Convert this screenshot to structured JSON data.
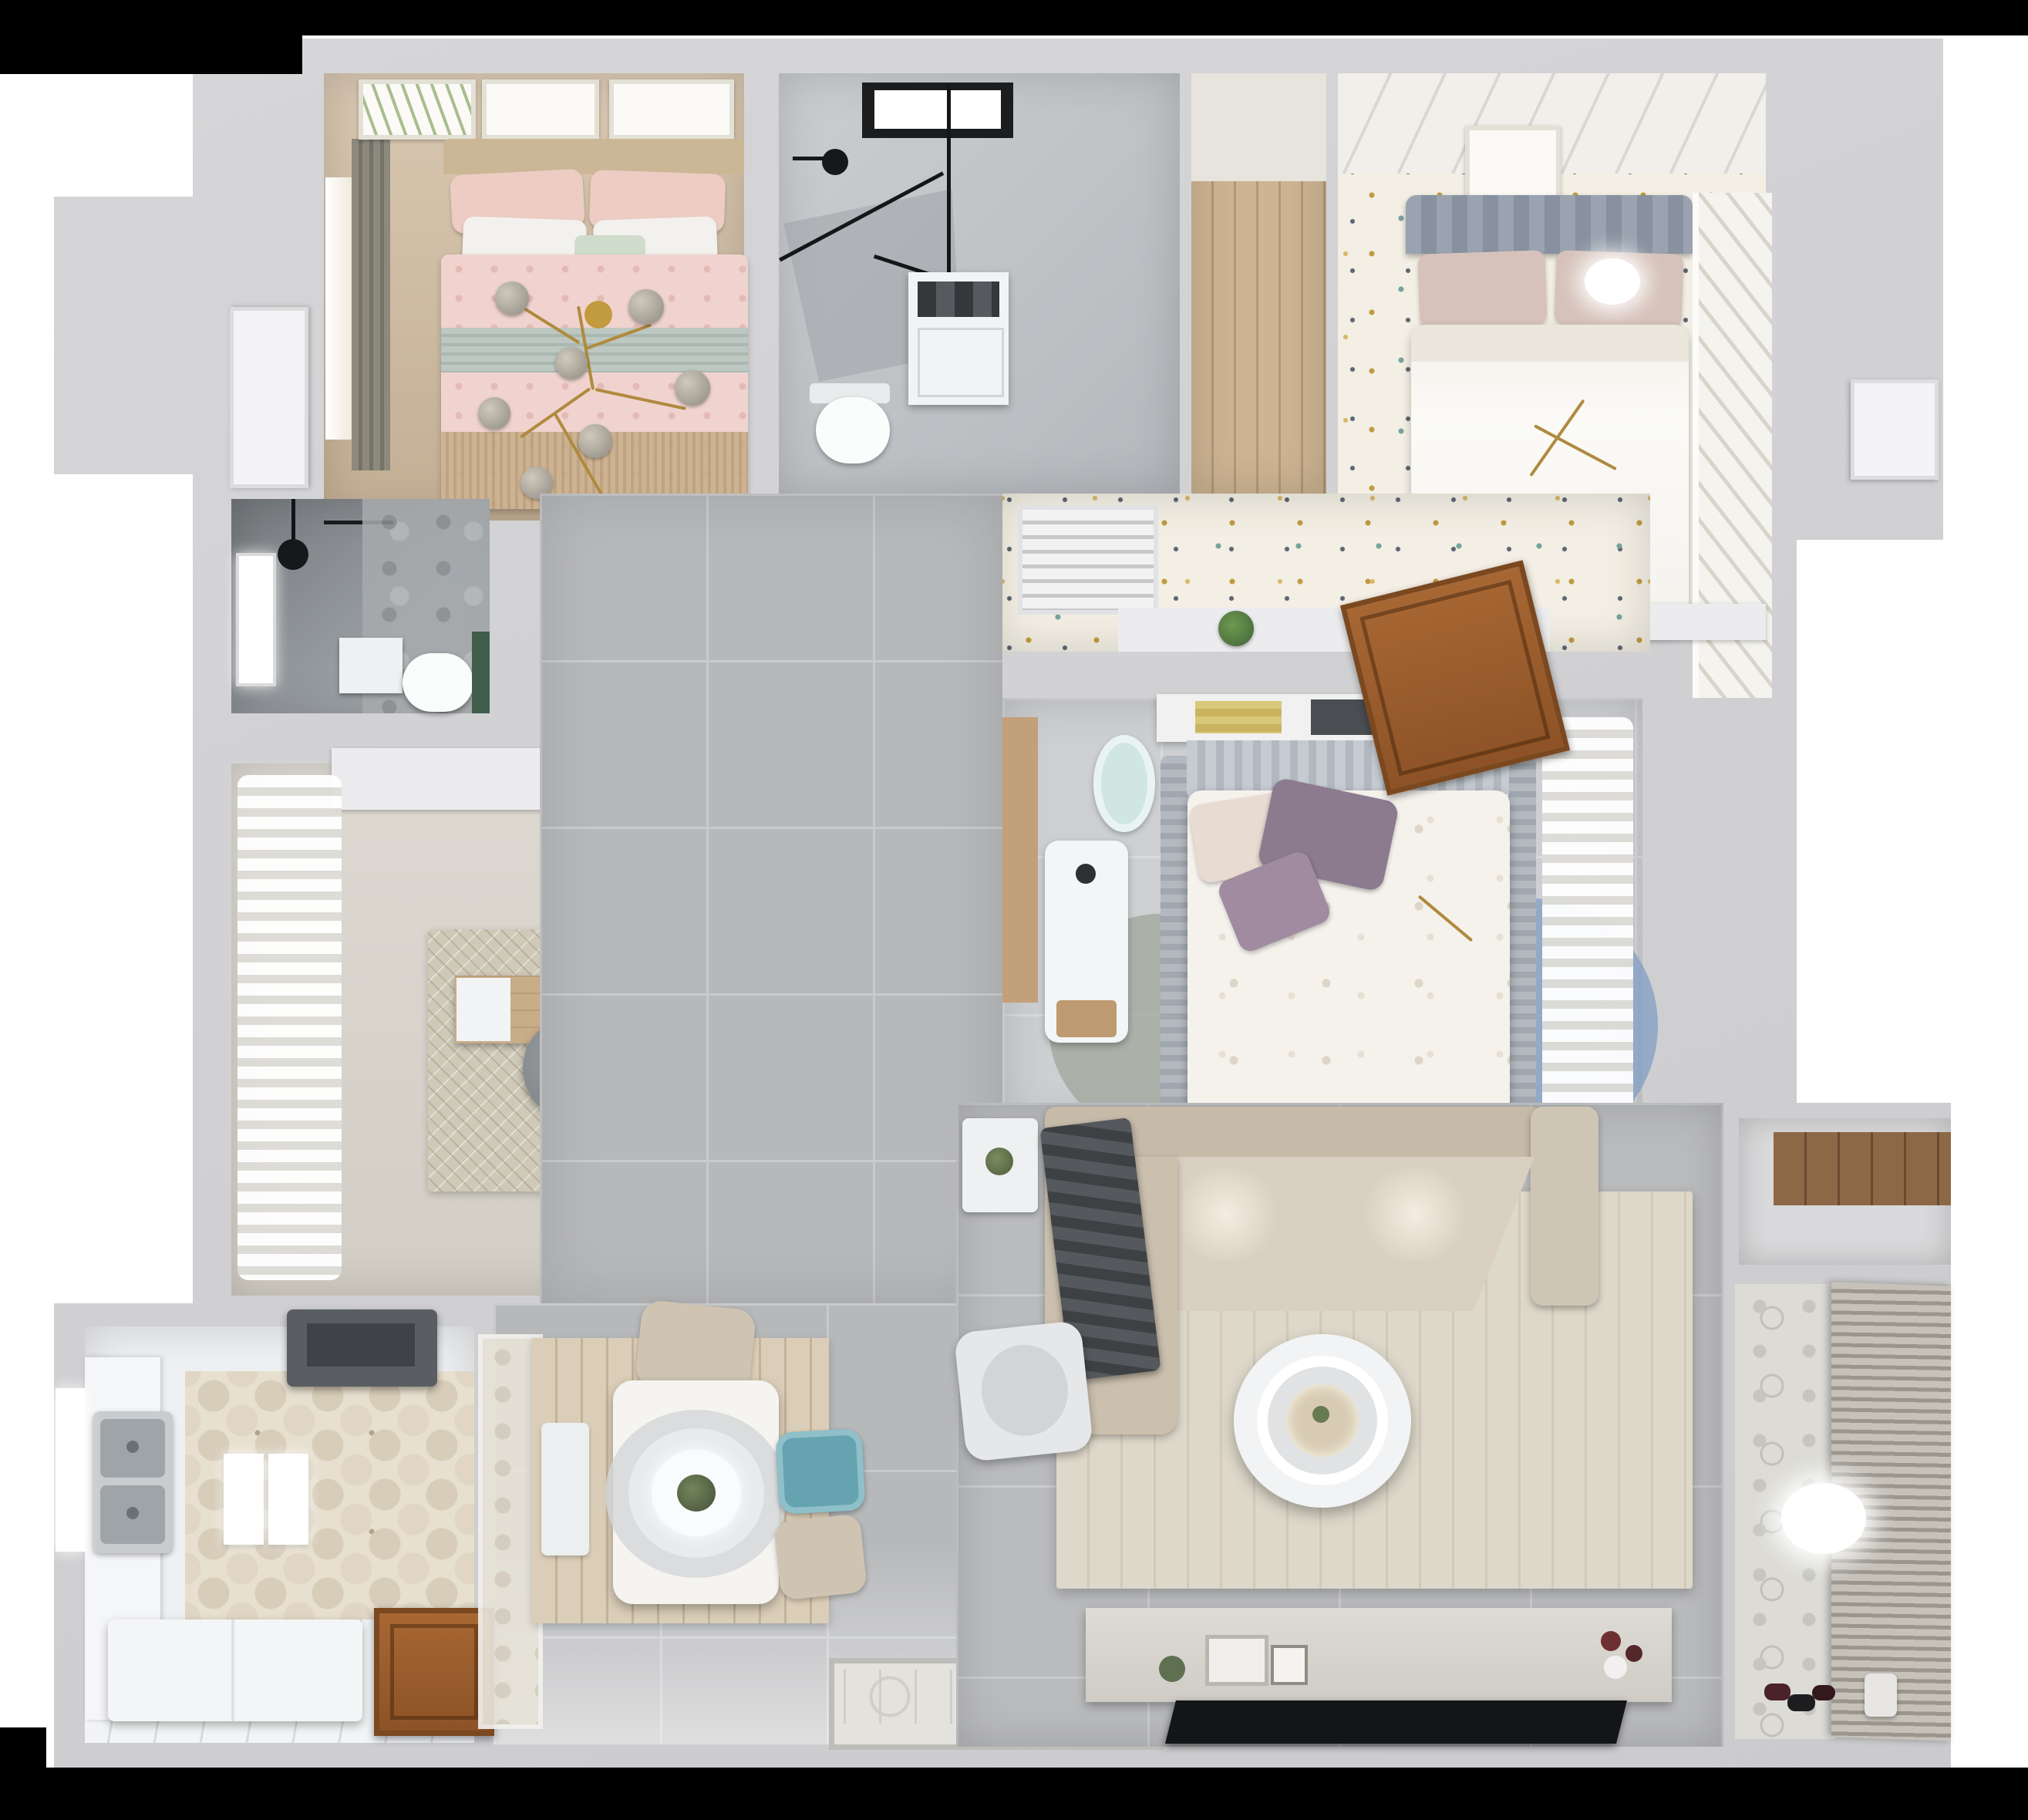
{
  "scene": {
    "type": "3d-floor-plan-top-down-render",
    "description": "Photorealistic dollhouse-view rendering of a three-bedroom apartment with two bathrooms, study, kitchen, dining area, living room and balcony. No text appears in the image.",
    "rooms": [
      {
        "id": "bedroom-pink",
        "name": "master bedroom with pink bedding",
        "furniture": [
          "double bed with pink patterned duvet",
          "white and pink pillows",
          "sage green band blanket",
          "gold branch chandelier with glass globes",
          "three wall picture frames",
          "window with dark curtain",
          "tan wood floor",
          "fringe rug"
        ]
      },
      {
        "id": "bathroom-top",
        "name": "main bathroom",
        "furniture": [
          "black framed walk-in shower",
          "black shower head",
          "wall hung toilet",
          "washing machine",
          "frosted black-framed window",
          "gray marble tile"
        ]
      },
      {
        "id": "closet-hall",
        "name": "wood floored closet nook",
        "furniture": [
          "bare wood plank floor"
        ]
      },
      {
        "id": "bedroom-white",
        "name": "bedroom with white bed and terrazzo-dot floor",
        "furniture": [
          "double bed with white duvet",
          "gray ribbed headboard",
          "beige pillows",
          "ceiling light glow",
          "picture frame",
          "white louvered sliding wardrobe",
          "speckled dot floor",
          "plank ceiling strip"
        ]
      },
      {
        "id": "corridor-dressing",
        "name": "dressing corridor outside bedrooms",
        "furniture": [
          "white louvered AC vent",
          "open wooden door",
          "potted plant on half-wall ledge",
          "speckled dot floor"
        ]
      },
      {
        "id": "bedroom-middle",
        "name": "middle bedroom",
        "furniture": [
          "bed with floral white duvet",
          "purple accent pillows",
          "gray upholstered side rails",
          "headboard shelf with books",
          "two teal round stools",
          "white desk with wood drawer",
          "trio of overlapping round rugs in blue, mauve and gray",
          "sheer curtain wall"
        ]
      },
      {
        "id": "shower-room",
        "name": "dark tiled shower room",
        "furniture": [
          "black ceiling shower head",
          "bright window",
          "toilet",
          "white wall box",
          "green plant accent",
          "marble floor"
        ]
      },
      {
        "id": "study",
        "name": "study",
        "furniture": [
          "wavy sheer curtains",
          "L-shaped wood desk",
          "white side panel",
          "dark monitor",
          "gray office chair",
          "wooden side chair",
          "mottled beige rug",
          "dark framed doormat",
          "white wall cabinet"
        ]
      },
      {
        "id": "kitchen",
        "name": "kitchen",
        "furniture": [
          "dark range hood",
          "stainless double sink",
          "white counter run",
          "two upright white panels",
          "white island block",
          "hexagonal patterned tile",
          "white plank floor",
          "brown entry door",
          "frosted glass partition",
          "side window"
        ]
      },
      {
        "id": "dining",
        "name": "dining area",
        "furniture": [
          "white rectangular table",
          "large ring pendant lamp with plant center",
          "two beige chairs",
          "one teal chair",
          "white bench",
          "wood plank rug"
        ]
      },
      {
        "id": "living-room",
        "name": "living room",
        "furniture": [
          "beige L-shaped sofa with lit seats",
          "dark gray throw on chaise",
          "cream area rug",
          "white double-ring coffee table",
          "light armchair",
          "white side table with plant",
          "long TV console with decor",
          "black flat TV",
          "gray floor tiles"
        ]
      },
      {
        "id": "balcony",
        "name": "balcony and laundry nook",
        "furniture": [
          "horizontal roller blinds",
          "patterned tile wall",
          "round ceiling light glow",
          "wood storage shelf",
          "shoes on floor",
          "small bucket"
        ]
      },
      {
        "id": "entry",
        "name": "entry landing",
        "furniture": [
          "ornate patterned doormat",
          "light gray tile"
        ]
      },
      {
        "id": "exterior",
        "name": "building shell",
        "furniture": [
          "white service door on right wall",
          "white door at left wall",
          "letterbox black bars"
        ]
      }
    ],
    "palette": {
      "letterbox": "#000000",
      "outer_wall": "#d2d2d4",
      "inner_wall": "#ececee",
      "hall_tile": "#b7b8ba",
      "living_tile": "#babbbd",
      "pink_bed": "#f0d3cf",
      "sage_band": "#bcc8c1",
      "tan_wood": "#c9b69d",
      "marble": "#c5c8cb",
      "closet_wood": "#cdb493",
      "speckle_floor": "#f3efe4",
      "headboard_gray": "#9aa3af",
      "bedroom3_floor": "#cdcfd2",
      "study_floor": "#d8d4cb",
      "kitchen_hex": "#e8e0cf",
      "dining_rug": "#dbceb8",
      "cream_rug": "#ded8ca",
      "sofa_beige": "#cfc5b3",
      "teal_chair": "#66a3b1",
      "stool_teal": "#cfe6e3",
      "rug_blue": "#84a0c4",
      "rug_mauve": "#9b8390",
      "rug_graygreen": "#a3a89f",
      "door_wood": "#9a5c2c",
      "gold": "#b08a3e",
      "tv_black": "#141518",
      "plant_green": "#4e7a46"
    }
  }
}
